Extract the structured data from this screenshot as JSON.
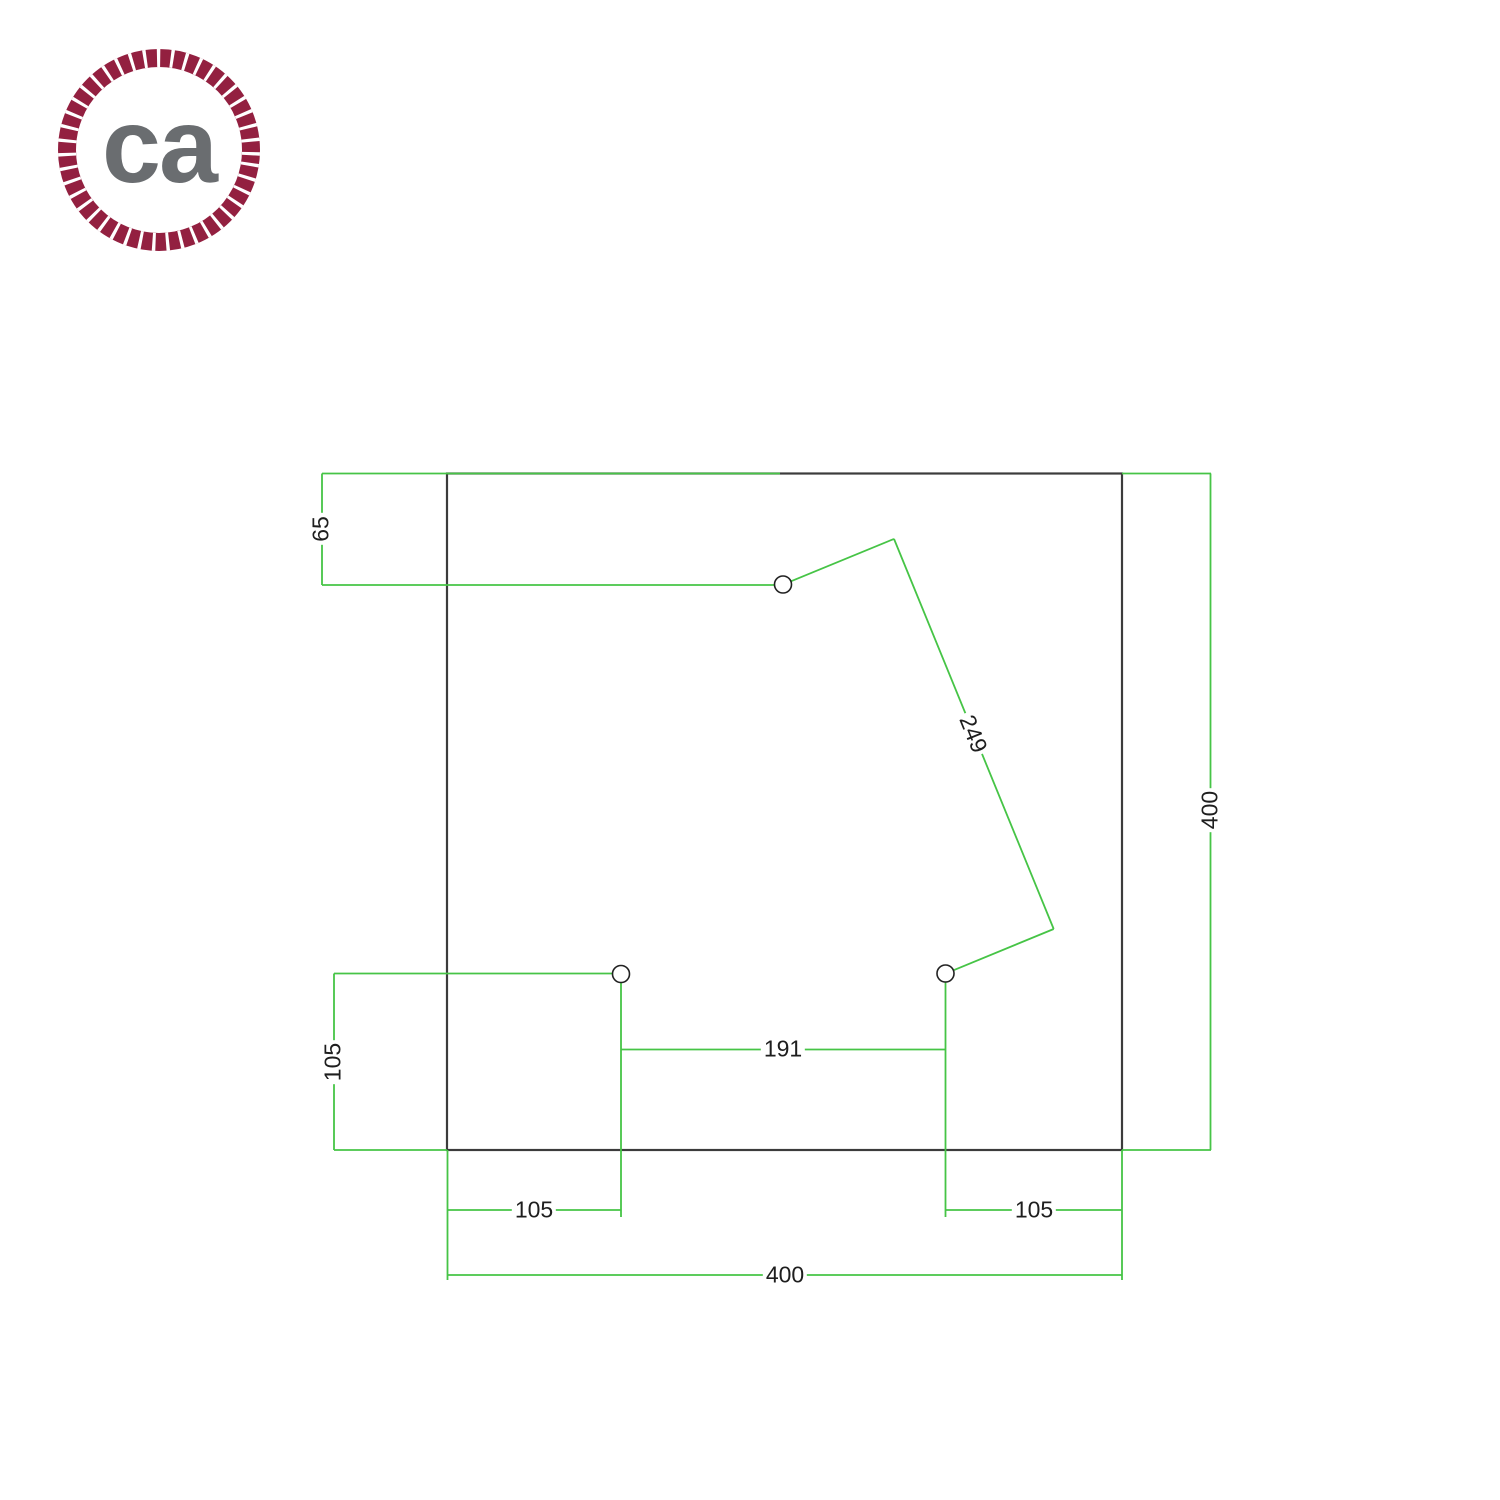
{
  "brand": {
    "initials": "ca",
    "ring_color": "#932040",
    "text_color": "#6a6d70"
  },
  "drawing": {
    "colors": {
      "dimension_line": "#46c446",
      "object_line": "#3c3c3c",
      "hole_line": "#222222",
      "label_text": "#1e1e1e",
      "background": "#ffffff"
    },
    "plate": {
      "x": 447,
      "y": 473.5,
      "width": 675,
      "height": 676.5
    },
    "holes": [
      {
        "name": "cable-hole-top",
        "cx": 783,
        "cy": 584.5,
        "r": 8.5
      },
      {
        "name": "cable-hole-bottom-left",
        "cx": 621,
        "cy": 974,
        "r": 8.5
      },
      {
        "name": "cable-hole-bottom-right",
        "cx": 945.5,
        "cy": 973.5,
        "r": 8.5
      }
    ],
    "lines": [
      {
        "name": "dim-65-ext-top",
        "x1": 322,
        "y1": 473.5,
        "x2": 780,
        "y2": 473.5
      },
      {
        "name": "dim-65-line",
        "x1": 322,
        "y1": 473.5,
        "x2": 322,
        "y2": 585
      },
      {
        "name": "dim-65-ext-bottom",
        "x1": 322,
        "y1": 585,
        "x2": 774,
        "y2": 585
      },
      {
        "name": "dim-400-right-ext-top",
        "x1": 1122,
        "y1": 473.5,
        "x2": 1211,
        "y2": 473.5
      },
      {
        "name": "dim-400-right-line",
        "x1": 1210.5,
        "y1": 473.5,
        "x2": 1210.5,
        "y2": 1150
      },
      {
        "name": "dim-400-right-ext-bottom",
        "x1": 1122,
        "y1": 1150,
        "x2": 1211,
        "y2": 1150
      },
      {
        "name": "dim-249-ext-a",
        "x1": 790.9,
        "y1": 581.3,
        "x2": 894,
        "y2": 538.9
      },
      {
        "name": "dim-249-line",
        "x1": 894,
        "y1": 538.9,
        "x2": 1053.7,
        "y2": 929
      },
      {
        "name": "dim-249-ext-b",
        "x1": 1053.7,
        "y1": 929,
        "x2": 953.4,
        "y2": 970.3
      },
      {
        "name": "dim-105-left-line",
        "x1": 334,
        "y1": 973.5,
        "x2": 334,
        "y2": 1150
      },
      {
        "name": "dim-105-left-ext-top",
        "x1": 334,
        "y1": 973.5,
        "x2": 612.5,
        "y2": 973.5
      },
      {
        "name": "dim-105-left-ext-bottom",
        "x1": 334,
        "y1": 1150,
        "x2": 447,
        "y2": 1150
      },
      {
        "name": "hole-bl-extension",
        "x1": 621,
        "y1": 982.5,
        "x2": 621,
        "y2": 1217
      },
      {
        "name": "hole-br-extension",
        "x1": 945.5,
        "y1": 982,
        "x2": 945.5,
        "y2": 1217
      },
      {
        "name": "dim-191-line",
        "x1": 621,
        "y1": 1049.5,
        "x2": 945.5,
        "y2": 1049.5
      },
      {
        "name": "dim-105-bottom-left-line",
        "x1": 447,
        "y1": 1210,
        "x2": 621,
        "y2": 1210
      },
      {
        "name": "dim-105-bottom-right-line",
        "x1": 945.5,
        "y1": 1210,
        "x2": 1122,
        "y2": 1210
      },
      {
        "name": "dim-400-bottom-ext-left",
        "x1": 447.5,
        "y1": 1150,
        "x2": 447.5,
        "y2": 1280
      },
      {
        "name": "dim-400-bottom-ext-right",
        "x1": 1122,
        "y1": 1150,
        "x2": 1122,
        "y2": 1280
      },
      {
        "name": "dim-400-bottom-line",
        "x1": 447.5,
        "y1": 1275,
        "x2": 1122,
        "y2": 1275
      }
    ],
    "labels": [
      {
        "name": "dim-65-label",
        "text": "65",
        "x": 321,
        "y": 529,
        "rotate": -90
      },
      {
        "name": "dim-249-label",
        "text": "249",
        "x": 973,
        "y": 734,
        "rotate": 68
      },
      {
        "name": "dim-400-right-label",
        "text": "400",
        "x": 1210,
        "y": 810,
        "rotate": -90
      },
      {
        "name": "dim-105-left-label",
        "text": "105",
        "x": 333,
        "y": 1062,
        "rotate": -90
      },
      {
        "name": "dim-191-label",
        "text": "191",
        "x": 783,
        "y": 1049,
        "rotate": 0
      },
      {
        "name": "dim-105-bottom-left-label",
        "text": "105",
        "x": 534,
        "y": 1210,
        "rotate": 0
      },
      {
        "name": "dim-105-bottom-right-label",
        "text": "105",
        "x": 1034,
        "y": 1210,
        "rotate": 0
      },
      {
        "name": "dim-400-bottom-label",
        "text": "400",
        "x": 785,
        "y": 1275,
        "rotate": 0
      }
    ]
  }
}
